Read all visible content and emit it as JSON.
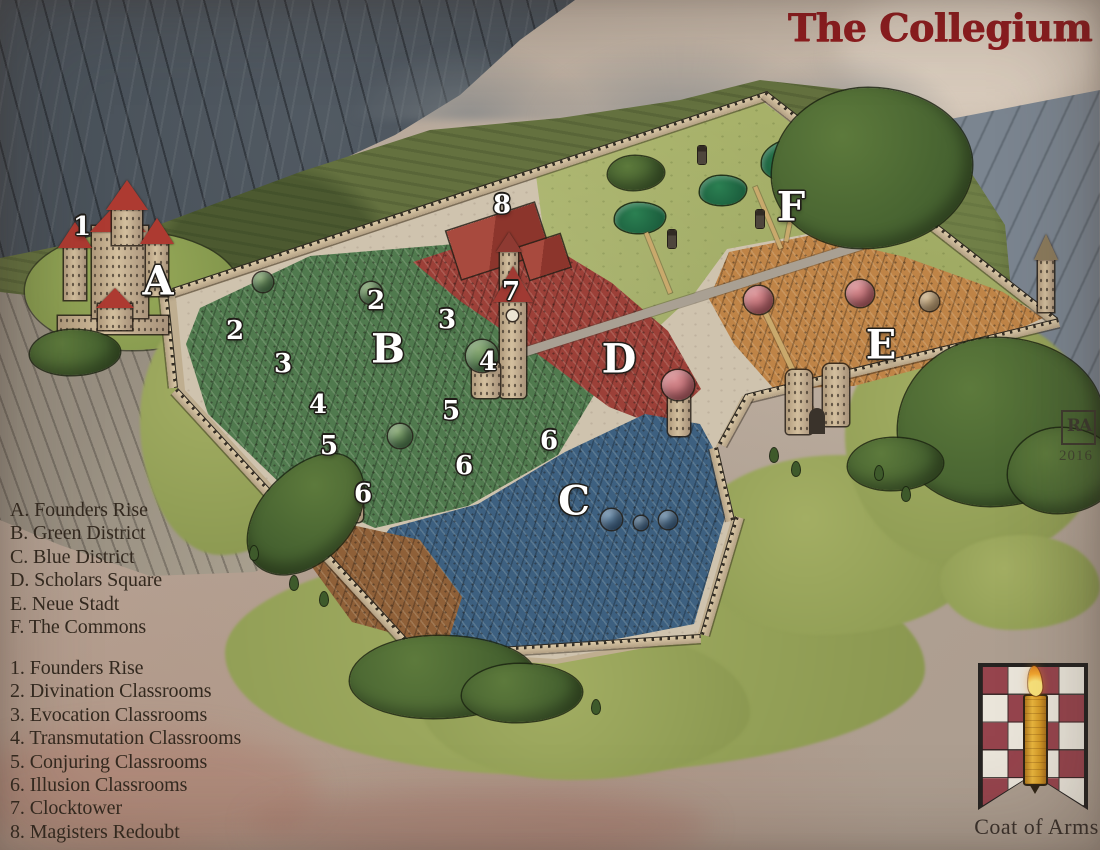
{
  "title": "The Collegium",
  "legend": {
    "districts": [
      {
        "key": "A",
        "name": "Founders Rise"
      },
      {
        "key": "B",
        "name": "Green District"
      },
      {
        "key": "C",
        "name": "Blue District"
      },
      {
        "key": "D",
        "name": "Scholars Square"
      },
      {
        "key": "E",
        "name": "Neue Stadt"
      },
      {
        "key": "F",
        "name": "The Commons"
      }
    ],
    "locations": [
      {
        "key": "1",
        "name": "Founders Rise"
      },
      {
        "key": "2",
        "name": "Divination Classrooms"
      },
      {
        "key": "3",
        "name": "Evocation Classrooms"
      },
      {
        "key": "4",
        "name": "Transmutation Classrooms"
      },
      {
        "key": "5",
        "name": "Conjuring Classrooms"
      },
      {
        "key": "6",
        "name": "Illusion Classrooms"
      },
      {
        "key": "7",
        "name": "Clocktower"
      },
      {
        "key": "8",
        "name": "Magisters Redoubt"
      }
    ]
  },
  "map_labels": {
    "districts": [
      {
        "text": "A",
        "x": 158,
        "y": 283
      },
      {
        "text": "B",
        "x": 388,
        "y": 351
      },
      {
        "text": "C",
        "x": 574,
        "y": 503
      },
      {
        "text": "D",
        "x": 619,
        "y": 361
      },
      {
        "text": "E",
        "x": 881,
        "y": 347
      },
      {
        "text": "F",
        "x": 791,
        "y": 209
      }
    ],
    "locations": [
      {
        "text": "1",
        "x": 82,
        "y": 228
      },
      {
        "text": "2",
        "x": 235,
        "y": 332
      },
      {
        "text": "2",
        "x": 376,
        "y": 302
      },
      {
        "text": "3",
        "x": 283,
        "y": 365
      },
      {
        "text": "3",
        "x": 447,
        "y": 321
      },
      {
        "text": "4",
        "x": 318,
        "y": 406
      },
      {
        "text": "4",
        "x": 488,
        "y": 363
      },
      {
        "text": "5",
        "x": 329,
        "y": 447
      },
      {
        "text": "5",
        "x": 451,
        "y": 412
      },
      {
        "text": "6",
        "x": 363,
        "y": 495
      },
      {
        "text": "6",
        "x": 464,
        "y": 467
      },
      {
        "text": "6",
        "x": 549,
        "y": 442
      },
      {
        "text": "7",
        "x": 511,
        "y": 293
      },
      {
        "text": "8",
        "x": 502,
        "y": 206
      }
    ]
  },
  "signature": {
    "monogram": "RA",
    "year": "2016"
  },
  "coat_of_arms": {
    "caption": "Coat of Arms"
  },
  "colors": {
    "title": "#8e1b1e",
    "ink": "#33291f",
    "label_fill": "#ffffff",
    "label_outline": "#201d18",
    "district_green": "#507a4e",
    "district_blue": "#3d6080",
    "district_red": "#9c4038",
    "district_orange": "#bf8447",
    "district_brown": "#8f6038",
    "commons_grass": "#a7b169",
    "checker_red": "#96444d",
    "candle_gold": "#dda32c"
  }
}
